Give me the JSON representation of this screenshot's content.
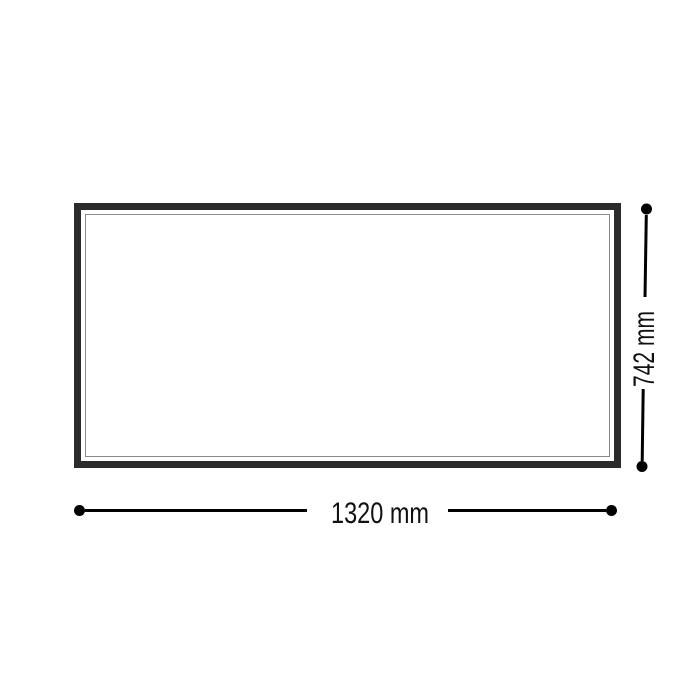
{
  "diagram": {
    "type": "dimension-drawing",
    "object": "rectangular-frame-front-view",
    "colors": {
      "background": "#ffffff",
      "frame": "#2b2b2b",
      "frame_inner_line": "#8a8a8a",
      "dimension_line": "#000000",
      "label_text": "#111111"
    },
    "width": {
      "value_mm": 1320,
      "label": "1320 mm"
    },
    "height": {
      "value_mm": 742,
      "label": "742 mm"
    }
  }
}
